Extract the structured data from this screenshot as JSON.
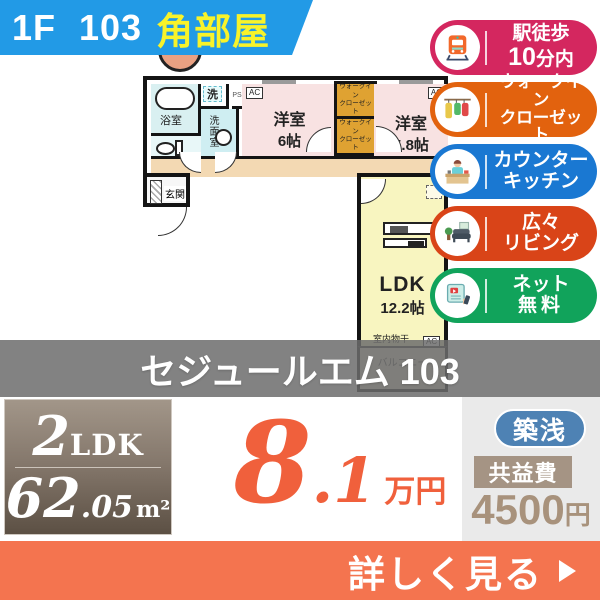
{
  "banner": {
    "unit_label": "1F 103",
    "corner_label": "角部屋"
  },
  "colors": {
    "banner_blue": "#229ae6",
    "cta_orange": "#f4744f",
    "price_orange": "#f0603c",
    "age_badge_blue": "#4e82b4",
    "fee_label_taupe": "#a59484"
  },
  "floorplan": {
    "bath_label": "浴室",
    "washer_label": "洗",
    "ps_label": "PS",
    "washroom_label": "洗面室",
    "entrance_label": "玄関",
    "western1_name": "洋室",
    "western1_size": "6帖",
    "western2_name": "洋室",
    "western2_size": "5.8帖",
    "wic_line1": "ウォークイン",
    "wic_line2": "クローゼット",
    "ldk_name": "LDK",
    "ldk_size": "12.2帖",
    "drying_label": "室内物干",
    "balcony_label": "バルコニー",
    "ac_label": "AC"
  },
  "badges": [
    {
      "line1": "駅徒歩",
      "line2_big": "10",
      "line2_small": "分内",
      "color": "#d4275f",
      "icon": "train-icon"
    },
    {
      "line1": "ウォークイン",
      "line2": "クローゼット",
      "color": "#e2620e",
      "icon": "walkin-closet-icon"
    },
    {
      "line1": "カウンター",
      "line2": "キッチン",
      "color": "#1a78d2",
      "icon": "counter-kitchen-icon"
    },
    {
      "line1": "広々",
      "line2": "リビング",
      "color": "#d94418",
      "icon": "living-sofa-icon"
    },
    {
      "line1": "ネット",
      "line2": "無料",
      "color": "#11a35b",
      "icon": "free-internet-icon"
    }
  ],
  "title": {
    "building_name": "セジュールエム 103"
  },
  "summary": {
    "layout_num": "2",
    "layout_word": "LDK",
    "area_int": "62",
    "area_dec": ".05",
    "area_unit": "m²",
    "rent_int": "8",
    "rent_dec": ".1",
    "rent_unit": "万円",
    "age_badge": "築浅",
    "fee_label": "共益費",
    "fee_value": "4500",
    "fee_unit": "円"
  },
  "cta": {
    "label": "詳しく見る"
  }
}
